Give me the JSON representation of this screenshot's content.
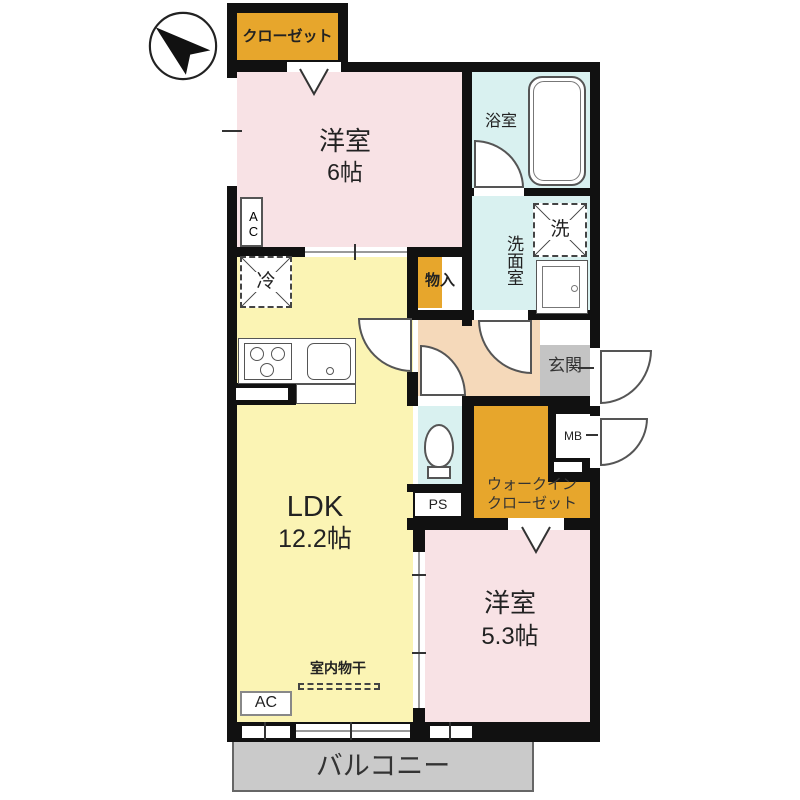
{
  "plan_title": "2LDK apartment floor plan",
  "colors": {
    "wall": "#111111",
    "bedroom_pink": "#f8e2e5",
    "ldk_yellow": "#fbf4b4",
    "wet_area_cyan": "#d9f1f0",
    "hall_peach": "#f5d9ba",
    "closet_orange": "#e7a62c",
    "entrance_gray": "#c4c4c4",
    "balcony_gray": "#cacaca"
  },
  "rooms": {
    "closet": "クローゼット",
    "bedroom6": {
      "name": "洋室",
      "size": "6帖"
    },
    "bath": "浴室",
    "washroom": "洗面室",
    "washer": "洗",
    "fridge": "冷",
    "storage": "物入",
    "entrance": "玄関",
    "mb": "MB",
    "ps": "PS",
    "wic_line1": "ウォークイン",
    "wic_line2": "クローゼット",
    "ldk": {
      "name": "LDK",
      "size": "12.2帖"
    },
    "bedroom53": {
      "name": "洋室",
      "size": "5.3帖"
    },
    "laundry": "室内物干",
    "ac_upper": "AC",
    "ac_lower": "AC",
    "balcony": "バルコニー"
  }
}
